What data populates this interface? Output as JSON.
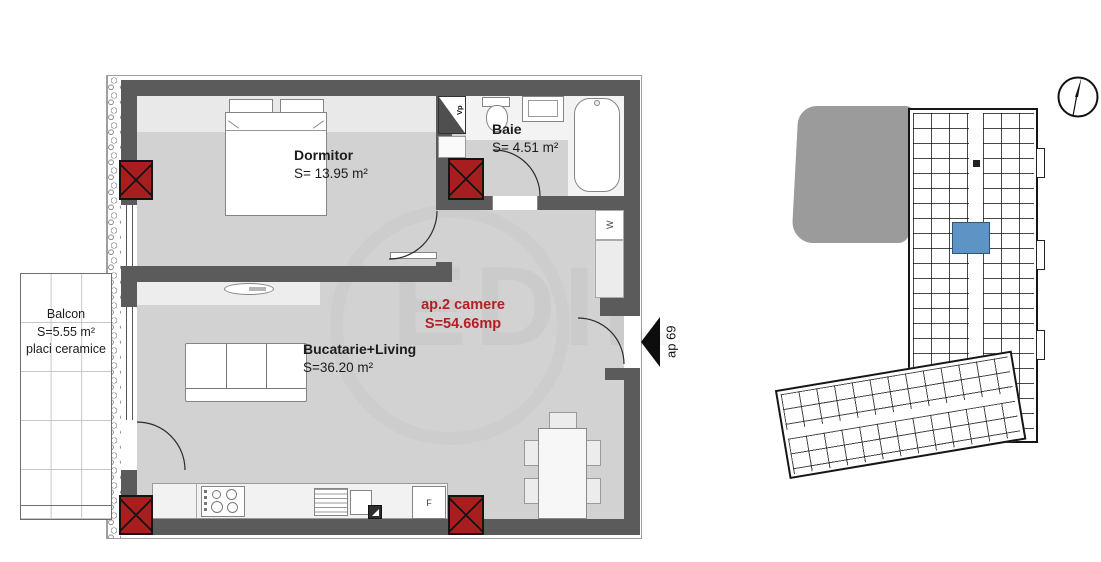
{
  "plan": {
    "rooms": {
      "dormitor": {
        "name": "Dormitor",
        "area": "S= 13.95 m²"
      },
      "baie": {
        "name": "Baie",
        "area": "S= 4.51 m²"
      },
      "living": {
        "name": "Bucatarie+Living",
        "area": "S=36.20 m²"
      },
      "balcon": {
        "name": "Balcon",
        "area": "S=5.55 m²",
        "finish": "placi ceramice"
      }
    },
    "apartment_label": {
      "line1": "ap.2 camere",
      "line2": "S=54.66mp"
    },
    "entrance": {
      "label": "ap 69"
    },
    "markers": {
      "ventilation": "Vp",
      "washer": "W",
      "fridge": "F"
    },
    "watermark": "EDIL"
  },
  "overview": {
    "highlighted_unit": "ap 69",
    "compass": "north-indicator"
  },
  "colors": {
    "wall": "#5b5b5b",
    "column_red": "#a81e1e",
    "accent_red": "#b22026",
    "floor": "#d2d2d2",
    "floor_light": "#e9e9e9",
    "counter": "#f2f2f2",
    "highlight_blue": "#5e94c5",
    "adjacent_building": "#9b9b9b"
  }
}
